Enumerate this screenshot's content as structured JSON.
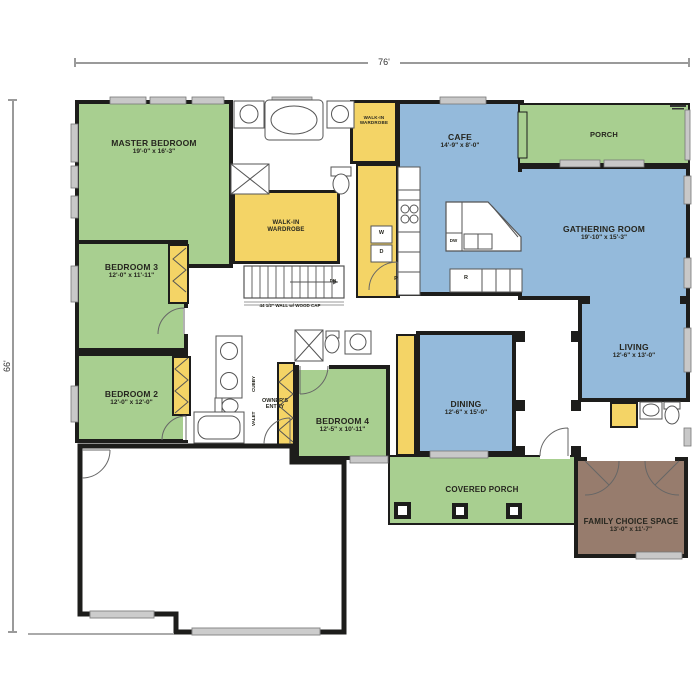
{
  "plan": {
    "width_dim": "76'",
    "height_dim": "66'"
  },
  "rooms": {
    "master_bedroom": {
      "name": "MASTER BEDROOM",
      "size": "19'-0\" x 16'-3\""
    },
    "bedroom_3": {
      "name": "BEDROOM 3",
      "size": "12'-0\" x 11'-11\""
    },
    "bedroom_2": {
      "name": "BEDROOM 2",
      "size": "12'-0\" x 12'-0\""
    },
    "bedroom_4": {
      "name": "BEDROOM 4",
      "size": "12'-5\" x 10'-11\""
    },
    "walk_in_wardrobe_master": {
      "name": "WALK-IN WARDROBE"
    },
    "walk_in_wardrobe_small": {
      "name": "WALK-IN WARDROBE"
    },
    "cafe": {
      "name": "CAFE",
      "size": "14'-9\" x 8'-0\""
    },
    "porch": {
      "name": "PORCH"
    },
    "gathering_room": {
      "name": "GATHERING ROOM",
      "size": "19'-10\" x 15'-3\""
    },
    "living": {
      "name": "LIVING",
      "size": "12'-6\" x 13'-0\""
    },
    "dining": {
      "name": "DINING",
      "size": "12'-6\" x 15'-0\""
    },
    "covered_porch": {
      "name": "COVERED PORCH"
    },
    "family_choice_space": {
      "name": "FAMILY CHOICE SPACE",
      "size": "13'-0\" x 11'-7\""
    },
    "garage": {
      "name": "GARAGE",
      "size": "33'-4\" x 23'-7\""
    },
    "owners_entry": {
      "name": "OWNER'S ENTRY"
    }
  },
  "annotations": {
    "stairs_note": "44 1/2\" WALL w/ WOOD CAP",
    "stairs_direction": "DN",
    "washer": "W",
    "dryer": "D",
    "pantry": "P",
    "refrigerator": "R",
    "dishwasher": "DW",
    "cubby": "CUBBY",
    "valet": "VALET"
  },
  "colors": {
    "bedroom_green": "#a8cf90",
    "living_blue": "#94badb",
    "storage_yellow": "#f4d466",
    "flex_brown": "#977c6d",
    "wall": "#1d1d1b",
    "dimension_gray": "#9a9a9a"
  }
}
